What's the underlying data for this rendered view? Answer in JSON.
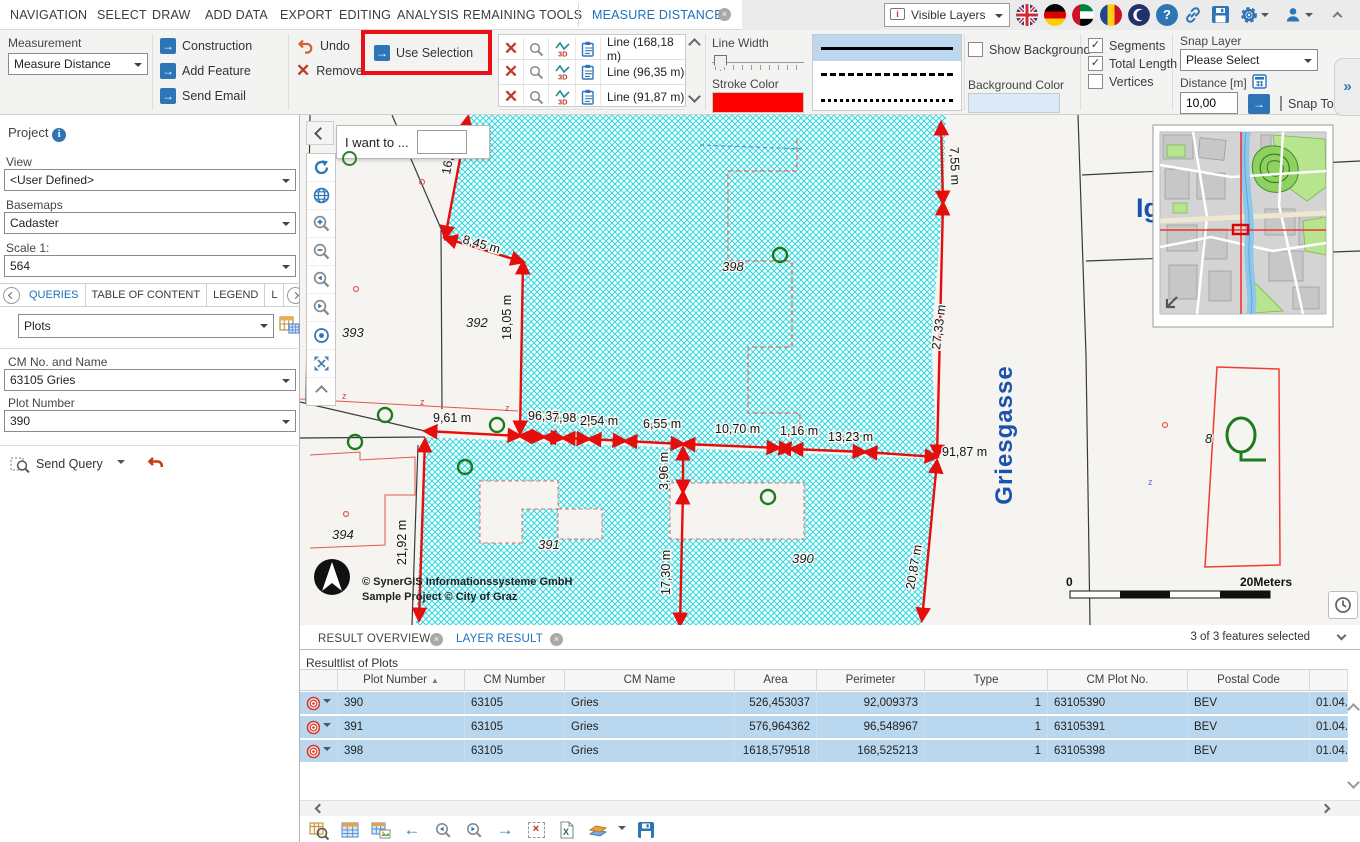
{
  "menu": {
    "items": [
      "NAVIGATION",
      "SELECT",
      "DRAW",
      "ADD DATA",
      "EXPORT",
      "EDITING",
      "ANALYSIS",
      "REMAINING TOOLS"
    ],
    "active_tab": "MEASURE DISTANCE",
    "visible_layers": "Visible Layers"
  },
  "ribbon": {
    "measurement_label": "Measurement",
    "measurement_value": "Measure Distance",
    "construction": "Construction",
    "add_feature": "Add Feature",
    "send_email": "Send Email",
    "undo": "Undo",
    "remove_all": "Remove All",
    "use_selection": "Use Selection",
    "lines": [
      "Line (168,18 m)",
      "Line (96,35 m)",
      "Line (91,87 m)"
    ],
    "line_width_label": "Line Width",
    "stroke_color_label": "Stroke Color",
    "stroke_color": "#fe0000",
    "show_background": "Show Background",
    "background_color_label": "Background Color",
    "background_color": "#dce9f8",
    "segments": "Segments",
    "total_length": "Total Length",
    "vertices": "Vertices",
    "snap_layer_label": "Snap Layer",
    "snap_layer_value": "Please Select",
    "distance_label": "Distance [m]",
    "distance_value": "10,00",
    "snap_to_sketch": "Snap To Sketch"
  },
  "sidebar": {
    "project": "Project",
    "view_label": "View",
    "view_value": "<User Defined>",
    "basemaps_label": "Basemaps",
    "basemaps_value": "Cadaster",
    "scale_label": "Scale 1:",
    "scale_value": "564",
    "tabs": [
      "QUERIES",
      "TABLE OF CONTENT",
      "LEGEND",
      "L"
    ],
    "query_theme": "Plots",
    "cm_label": "CM No. and Name",
    "cm_value": "63105 Gries",
    "plot_label": "Plot Number",
    "plot_value": "390",
    "send_query": "Send Query"
  },
  "map": {
    "i_want_to": "I want to ...",
    "street": "Griesgasse",
    "street_partial": "Ig",
    "copyright_line1": "© SynerGIS Informationssysteme GmbH",
    "copyright_line2": "Sample Project © City of Graz",
    "scale_zero": "0",
    "scale_units": "20Meters",
    "selection_color": "#35d7e1",
    "measure_color": "#e60d0d",
    "plot_labels": {
      "p393": "393",
      "p392": "392",
      "p398": "398",
      "p394": "394",
      "p391": "391",
      "p390": "390",
      "p8": "8"
    },
    "measurements": [
      "16,31 m",
      "8,45 m",
      "7,55 m",
      "18,05 m",
      "27,33 m",
      "9,61 m",
      "96,35 m",
      "7,98 m",
      "2,54 m",
      "6,55 m",
      "10,70 m",
      "1,16 m",
      "13,23 m",
      "91,87 m",
      "3,96 m",
      "21,92 m",
      "17,30 m",
      "20,87 m"
    ]
  },
  "results": {
    "tab_overview": "RESULT OVERVIEW",
    "tab_layer": "LAYER RESULT",
    "selection_info": "3 of 3 features selected",
    "list_title": "Resultlist of Plots",
    "columns": [
      "Plot Number",
      "CM Number",
      "CM Name",
      "Area",
      "Perimeter",
      "Type",
      "CM Plot No.",
      "Postal Code"
    ],
    "rows": [
      {
        "plot": "390",
        "cm_number": "63105",
        "cm_name": "Gries",
        "area": "526,453037",
        "perimeter": "92,009373",
        "type": "1",
        "cm_plot": "63105390",
        "postal": "BEV",
        "date": "01.04.2"
      },
      {
        "plot": "391",
        "cm_number": "63105",
        "cm_name": "Gries",
        "area": "576,964362",
        "perimeter": "96,548967",
        "type": "1",
        "cm_plot": "63105391",
        "postal": "BEV",
        "date": "01.04.2"
      },
      {
        "plot": "398",
        "cm_number": "63105",
        "cm_name": "Gries",
        "area": "1618,579518",
        "perimeter": "168,525213",
        "type": "1",
        "cm_plot": "63105398",
        "postal": "BEV",
        "date": "01.04.2"
      }
    ]
  }
}
